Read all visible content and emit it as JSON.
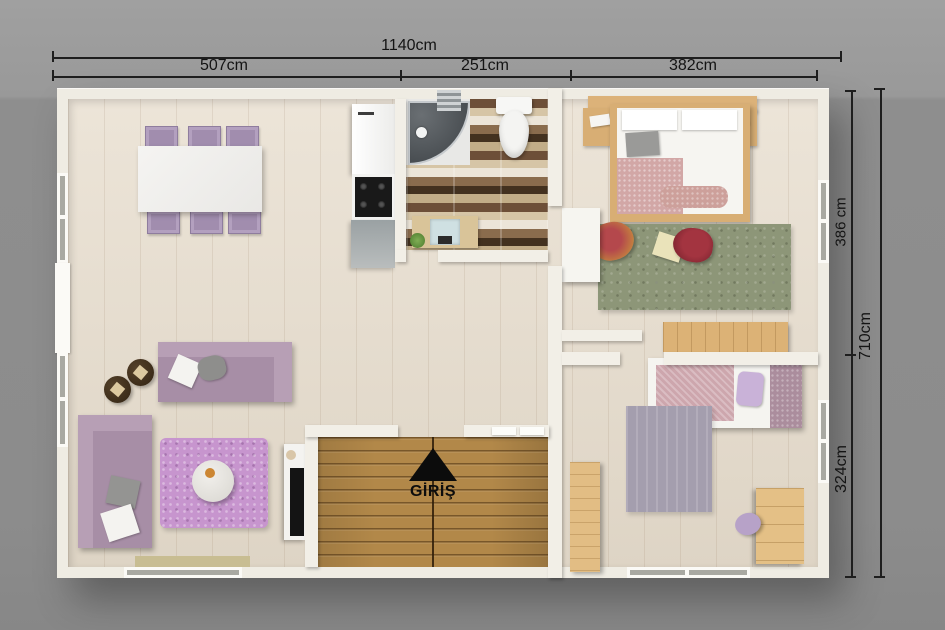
{
  "scene": {
    "background_color": "#8f8f8f"
  },
  "dimension_labels": {
    "top_total": "1140cm",
    "top_left_segment": "507cm",
    "top_middle_segment": "251cm",
    "top_right_segment": "382cm",
    "right_upper_segment": "386 cm",
    "right_total": "710cm",
    "right_lower_segment": "324cm"
  },
  "entrance": {
    "label": "GİRİŞ",
    "arrow_icon": "up-triangle"
  },
  "colors": {
    "wall": "#f2efe7",
    "floor_wood": "#e7ddcd",
    "deck_wood": "#b28849",
    "bathroom_tile_dark": "#43311f",
    "bathroom_tile_light": "#ece5d8",
    "sofa_mauve": "#a78ea6",
    "rug_purple": "#c795ce",
    "rug_green": "#8d9678",
    "rug_gray": "#a49eae",
    "bed_wood": "#d8ae74",
    "beanbag_red": "#a33440",
    "dimension_text": "#141414"
  }
}
